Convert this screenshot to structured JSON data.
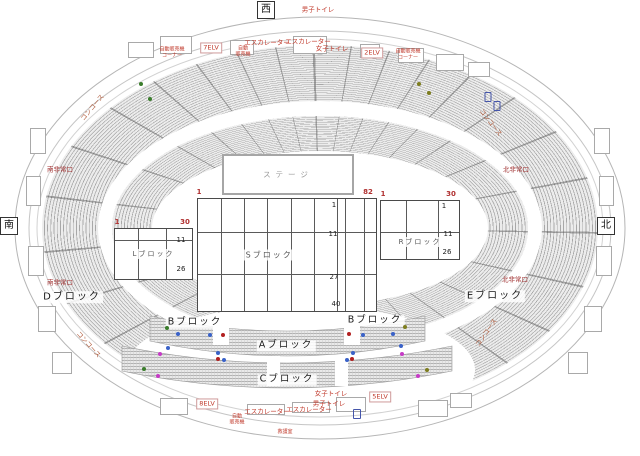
{
  "markers": {
    "west": "西",
    "south": "南",
    "north": "北"
  },
  "stage": {
    "label": "ステージ"
  },
  "floor": {
    "s_block": {
      "label": "Sブロック",
      "corner_left": "1",
      "corner_right": "82",
      "row_numbers": [
        "1",
        "11",
        "27",
        "40"
      ]
    },
    "l_block": {
      "label": "Lブロック",
      "corner_left": "1",
      "corner_right": "30",
      "row_numbers": [
        "11",
        "26"
      ]
    },
    "r_block": {
      "label": "Rブロック",
      "corner_left": "1",
      "corner_right": "30",
      "row_numbers": [
        "1",
        "11",
        "26"
      ]
    }
  },
  "labels": [
    {
      "text": "男子トイレ",
      "x": 318,
      "y": 10
    },
    {
      "text": "エスカレーター",
      "x": 267,
      "y": 43
    },
    {
      "text": "エスカレーター",
      "x": 308,
      "y": 42
    },
    {
      "text": "女子トイレ",
      "x": 332,
      "y": 49
    },
    {
      "text": "7ELV",
      "x": 211,
      "y": 48,
      "cls": "boxed"
    },
    {
      "text": "2ELV",
      "x": 372,
      "y": 53,
      "cls": "boxed"
    },
    {
      "text": "自動販売機\nコーナー",
      "x": 172,
      "y": 53,
      "cls": "tiny"
    },
    {
      "text": "自動\n販売機",
      "x": 243,
      "y": 52,
      "cls": "tiny"
    },
    {
      "text": "自動販売機\nコーナー",
      "x": 408,
      "y": 55,
      "cls": "tiny"
    },
    {
      "text": "コンコース",
      "x": 93,
      "y": 108,
      "rotate": -50,
      "color": "#b05a3a"
    },
    {
      "text": "コンコース",
      "x": 490,
      "y": 123,
      "rotate": 52,
      "color": "#b05a3a"
    },
    {
      "text": "コンコース",
      "x": 88,
      "y": 345,
      "rotate": 48,
      "color": "#b05a3a"
    },
    {
      "text": "コンコース",
      "x": 487,
      "y": 333,
      "rotate": -55,
      "color": "#b05a3a"
    },
    {
      "text": "南非常口",
      "x": 60,
      "y": 170,
      "color": "#a03030"
    },
    {
      "text": "南非常口",
      "x": 60,
      "y": 283,
      "color": "#a03030"
    },
    {
      "text": "北非常口",
      "x": 516,
      "y": 170,
      "color": "#a03030"
    },
    {
      "text": "北非常口",
      "x": 515,
      "y": 280,
      "color": "#a03030"
    },
    {
      "text": "Dブロック",
      "x": 72,
      "y": 297,
      "cls": "blk",
      "size": 10
    },
    {
      "text": "Eブロック",
      "x": 495,
      "y": 296,
      "cls": "blk",
      "size": 10
    },
    {
      "text": "Bブロック",
      "x": 195,
      "y": 323,
      "cls": "blk"
    },
    {
      "text": "Bブロック",
      "x": 375,
      "y": 321,
      "cls": "blk"
    },
    {
      "text": "Aブロック",
      "x": 286,
      "y": 346,
      "cls": "blk"
    },
    {
      "text": "Cブロック",
      "x": 287,
      "y": 380,
      "cls": "blk"
    },
    {
      "text": "8ELV",
      "x": 207,
      "y": 404,
      "cls": "boxed"
    },
    {
      "text": "5ELV",
      "x": 380,
      "y": 397,
      "cls": "boxed"
    },
    {
      "text": "エスカレーター",
      "x": 267,
      "y": 412
    },
    {
      "text": "エスカレーター",
      "x": 309,
      "y": 410
    },
    {
      "text": "女子トイレ",
      "x": 331,
      "y": 394
    },
    {
      "text": "男子トイレ",
      "x": 329,
      "y": 404
    },
    {
      "text": "自動\n販売機",
      "x": 237,
      "y": 420,
      "cls": "tiny"
    },
    {
      "text": "救護室",
      "x": 285,
      "y": 433,
      "cls": "tiny"
    }
  ],
  "dots": [
    {
      "x": 167,
      "y": 328,
      "fill": "#3a7d2c"
    },
    {
      "x": 144,
      "y": 369,
      "fill": "#3a7d2c"
    },
    {
      "x": 141,
      "y": 84,
      "fill": "#3a7d2c"
    },
    {
      "x": 150,
      "y": 99,
      "fill": "#3a7d2c"
    },
    {
      "x": 405,
      "y": 327,
      "fill": "#7d7d1e"
    },
    {
      "x": 427,
      "y": 370,
      "fill": "#7d7d1e"
    },
    {
      "x": 419,
      "y": 84,
      "fill": "#7d7d1e"
    },
    {
      "x": 429,
      "y": 93,
      "fill": "#7d7d1e"
    },
    {
      "x": 178,
      "y": 334,
      "fill": "#3a62c8"
    },
    {
      "x": 210,
      "y": 335,
      "fill": "#3a62c8"
    },
    {
      "x": 363,
      "y": 335,
      "fill": "#3a62c8"
    },
    {
      "x": 393,
      "y": 334,
      "fill": "#3a62c8"
    },
    {
      "x": 218,
      "y": 353,
      "fill": "#3a62c8"
    },
    {
      "x": 353,
      "y": 353,
      "fill": "#3a62c8"
    },
    {
      "x": 224,
      "y": 360,
      "fill": "#3a62c8"
    },
    {
      "x": 347,
      "y": 360,
      "fill": "#3a62c8"
    },
    {
      "x": 168,
      "y": 348,
      "fill": "#3a62c8"
    },
    {
      "x": 401,
      "y": 346,
      "fill": "#3a62c8"
    },
    {
      "x": 223,
      "y": 335,
      "fill": "#b22020"
    },
    {
      "x": 349,
      "y": 334,
      "fill": "#b22020"
    },
    {
      "x": 218,
      "y": 359,
      "fill": "#b22020"
    },
    {
      "x": 352,
      "y": 359,
      "fill": "#b22020"
    },
    {
      "x": 160,
      "y": 354,
      "fill": "#c63bc6"
    },
    {
      "x": 402,
      "y": 354,
      "fill": "#c63bc6"
    },
    {
      "x": 158,
      "y": 376,
      "fill": "#c63bc6"
    },
    {
      "x": 418,
      "y": 376,
      "fill": "#c63bc6"
    }
  ],
  "squares": [
    {
      "x": 488,
      "y": 97,
      "w": 5,
      "h": 8
    },
    {
      "x": 497,
      "y": 106,
      "w": 5,
      "h": 8
    },
    {
      "x": 357,
      "y": 414,
      "w": 6,
      "h": 8
    }
  ],
  "booths": [
    {
      "x": 128,
      "y": 42,
      "w": 24,
      "h": 14
    },
    {
      "x": 160,
      "y": 36,
      "w": 30,
      "h": 16
    },
    {
      "x": 230,
      "y": 40,
      "w": 22,
      "h": 13
    },
    {
      "x": 293,
      "y": 36,
      "w": 32,
      "h": 16
    },
    {
      "x": 360,
      "y": 44,
      "w": 18,
      "h": 12
    },
    {
      "x": 398,
      "y": 48,
      "w": 24,
      "h": 13
    },
    {
      "x": 436,
      "y": 54,
      "w": 26,
      "h": 15
    },
    {
      "x": 468,
      "y": 62,
      "w": 20,
      "h": 13
    },
    {
      "x": 160,
      "y": 398,
      "w": 26,
      "h": 15
    },
    {
      "x": 247,
      "y": 404,
      "w": 36,
      "h": 9
    },
    {
      "x": 292,
      "y": 402,
      "w": 36,
      "h": 9
    },
    {
      "x": 336,
      "y": 397,
      "w": 28,
      "h": 13
    },
    {
      "x": 418,
      "y": 400,
      "w": 28,
      "h": 15
    },
    {
      "x": 450,
      "y": 393,
      "w": 20,
      "h": 13
    },
    {
      "x": 30,
      "y": 128,
      "w": 14,
      "h": 24
    },
    {
      "x": 26,
      "y": 176,
      "w": 13,
      "h": 28
    },
    {
      "x": 28,
      "y": 246,
      "w": 14,
      "h": 28
    },
    {
      "x": 38,
      "y": 306,
      "w": 16,
      "h": 24
    },
    {
      "x": 52,
      "y": 352,
      "w": 18,
      "h": 20
    },
    {
      "x": 594,
      "y": 128,
      "w": 14,
      "h": 24
    },
    {
      "x": 599,
      "y": 176,
      "w": 13,
      "h": 28
    },
    {
      "x": 596,
      "y": 246,
      "w": 14,
      "h": 28
    },
    {
      "x": 584,
      "y": 306,
      "w": 16,
      "h": 24
    },
    {
      "x": 568,
      "y": 352,
      "w": 18,
      "h": 20
    }
  ]
}
